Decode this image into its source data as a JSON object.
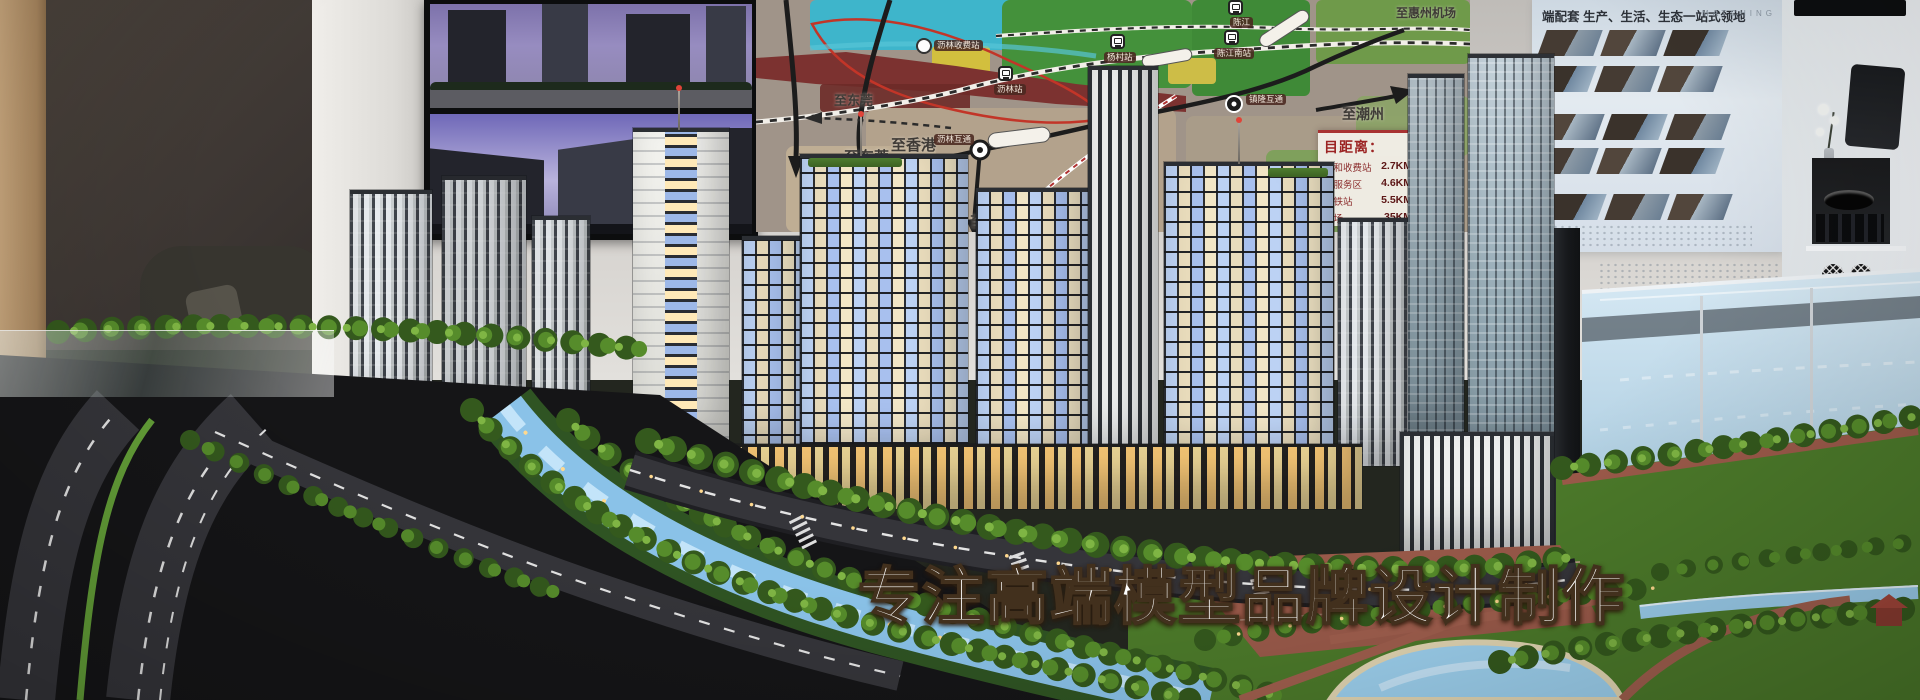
{
  "slogan": "专注高端模型品牌设计制作",
  "map": {
    "dest_dongguan_a": "至东莞",
    "dest_dongguan_b": "至东莞",
    "dest_hongkong": "至香港",
    "dest_shenzhen": "至深圳",
    "dest_chaozhou": "至潮州",
    "dest_huizhou_airport": "至惠州机场",
    "station_lilin_toll": "沥林收费站",
    "station_lilin": "沥林站",
    "station_yangcun": "杨村站",
    "station_chenjiang": "陈江",
    "station_chenjiang_south": "陈江南站",
    "interchange_lilin": "沥林互通",
    "interchange_zhenlong": "镇隆互通",
    "distance_panel": {
      "title": "目距离：",
      "rows": [
        {
          "label": "三和收费站",
          "value": "2.7KM"
        },
        {
          "label": "北服务区",
          "value": "4.6KM"
        },
        {
          "label": "高铁站",
          "value": "5.5KM"
        },
        {
          "label": "机场",
          "value": "35KM"
        }
      ]
    }
  },
  "display_wall": {
    "header_cn": "端配套 生产、生活、生态一站式领地",
    "header_en": "MATCHING"
  }
}
